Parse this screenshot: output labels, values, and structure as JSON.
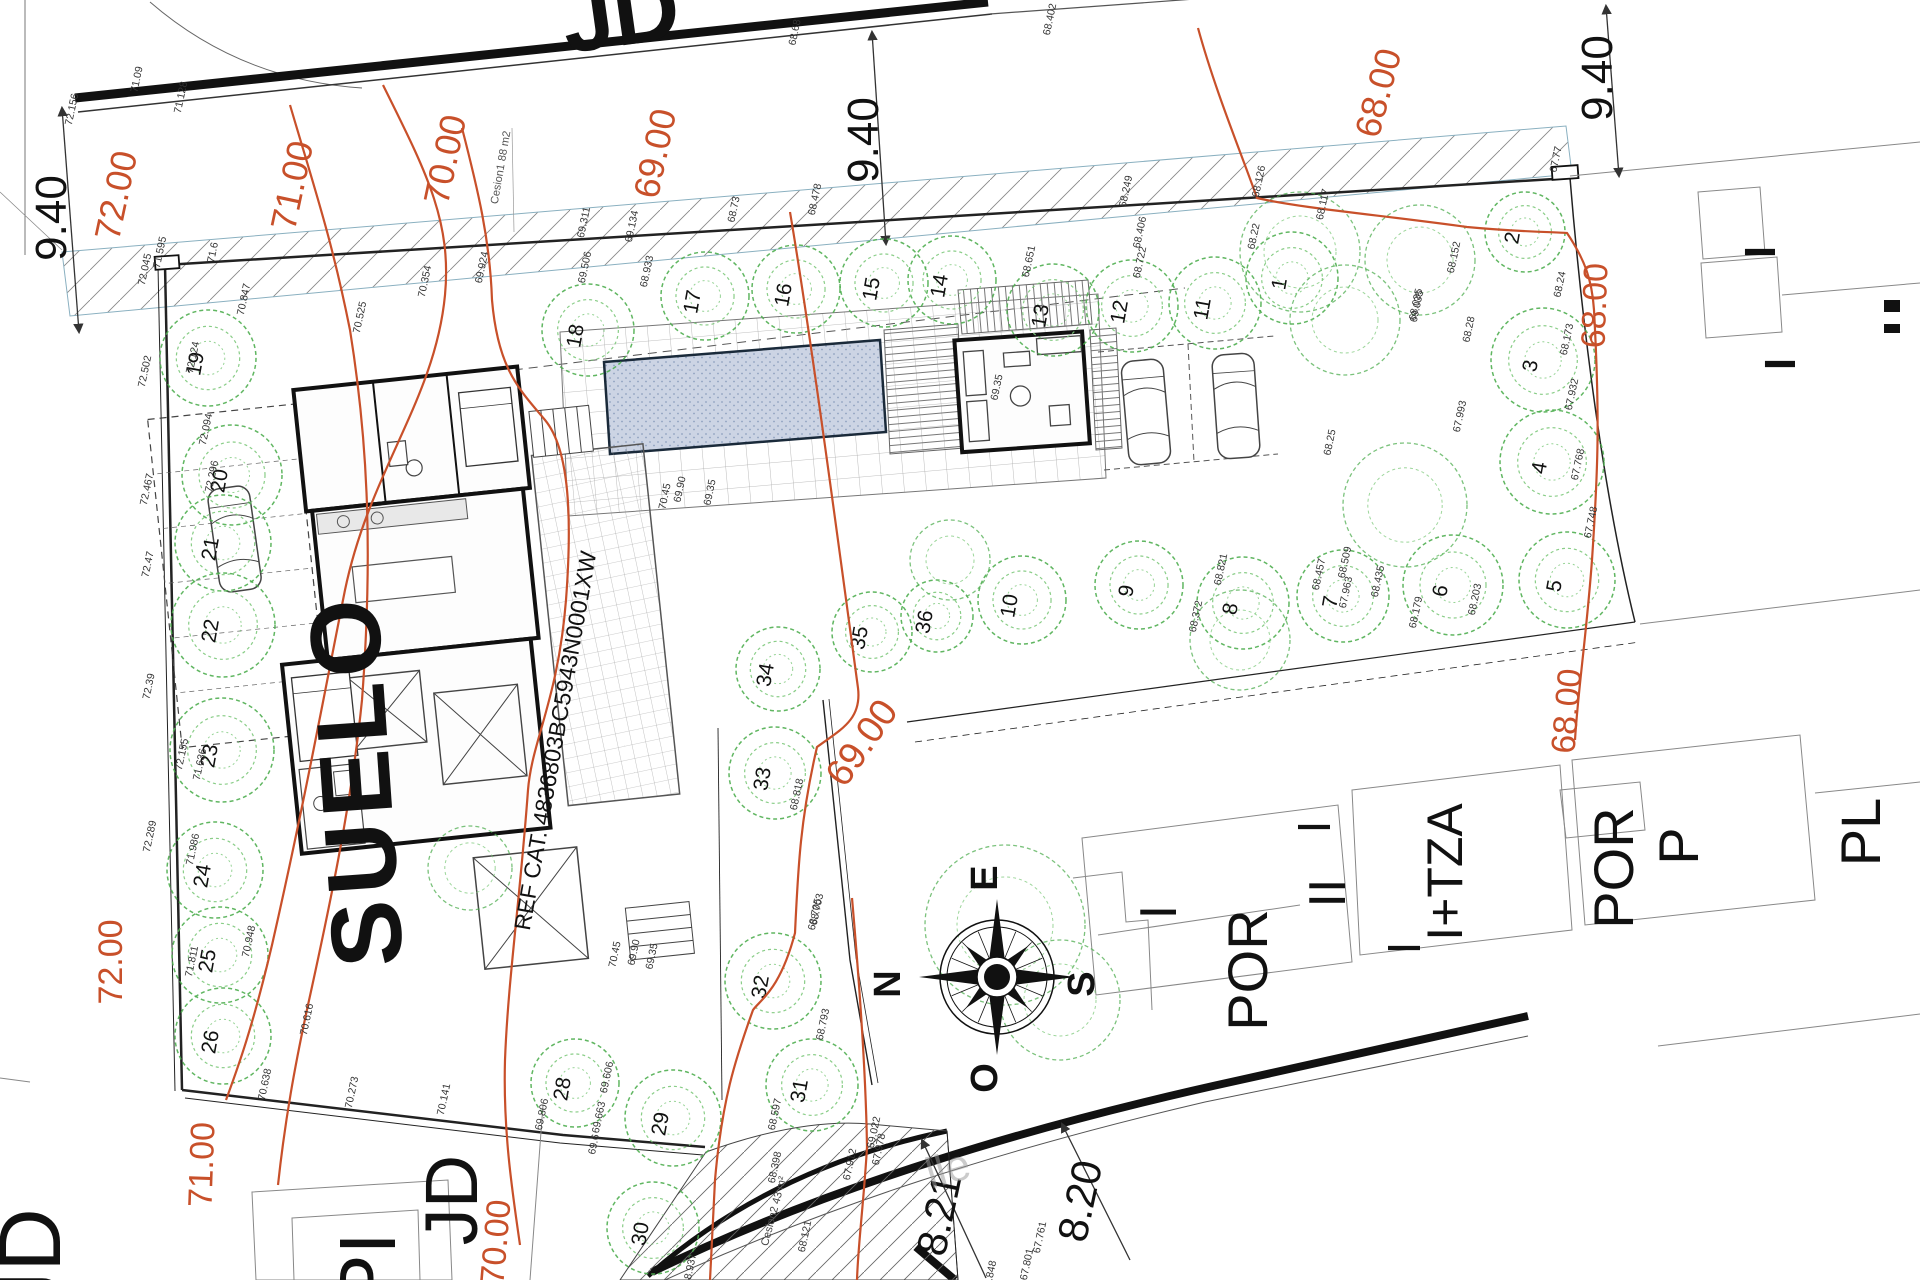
{
  "colors": {
    "contour": "#c8502a",
    "tree": "#4fae50",
    "tree_inner": "#7cc87a",
    "ink": "#111",
    "minor": "#333",
    "pool_fill": "#ccd4e4"
  },
  "contour_lines": [
    {
      "level": "72",
      "d": "M383,85 C425,170 452,220 445,295 C435,400 370,470 345,590 C325,690 305,800 272,945 C252,1030 237,1070 226,1100"
    },
    {
      "level": "71",
      "d": "M290,105 C315,190 332,240 350,330 C366,430 374,540 362,700 C352,800 330,905 308,1005 C295,1065 285,1120 278,1185"
    },
    {
      "level": "70",
      "d": "M462,128 C478,190 490,240 492,300 C498,370 520,390 545,420 C570,450 572,520 566,600 C558,700 532,740 528,790 C520,900 508,980 505,1060 C503,1130 512,1190 520,1245"
    },
    {
      "level": "69",
      "d": "M790,212 C810,330 838,540 858,688 C862,720 840,730 817,747 C800,820 798,870 795,933 C780,990 760,1000 753,1010 C735,1060 722,1100 715,1180 L710,1280"
    },
    {
      "level": "68",
      "d": "M1198,28 C1215,90 1240,150 1257,198 C1300,208 1380,215 1467,227 C1520,232 1555,232 1567,233 C1585,260 1592,280 1594,310 C1600,420 1598,470 1592,560 C1586,640 1578,690 1575,740"
    },
    {
      "level": "68b",
      "d": "M852,898 C860,990 866,1080 867,1147 C864,1200 858,1245 857,1280"
    }
  ],
  "contour_labels": [
    {
      "t": "72.00",
      "x": 128,
      "y": 198,
      "rot": -78,
      "size": 36
    },
    {
      "t": "71.00",
      "x": 304,
      "y": 188,
      "rot": -78,
      "size": 36
    },
    {
      "t": "70.00",
      "x": 457,
      "y": 162,
      "rot": -78,
      "size": 36
    },
    {
      "t": "69.00",
      "x": 667,
      "y": 156,
      "rot": -78,
      "size": 36
    },
    {
      "t": "68.00",
      "x": 1390,
      "y": 96,
      "rot": -75,
      "size": 36
    },
    {
      "t": "68.00",
      "x": 1606,
      "y": 306,
      "rot": -88,
      "size": 34
    },
    {
      "t": "68.00",
      "x": 1578,
      "y": 712,
      "rot": -85,
      "size": 34
    },
    {
      "t": "69.00",
      "x": 872,
      "y": 750,
      "rot": -55,
      "size": 38
    },
    {
      "t": "72.00",
      "x": 122,
      "y": 962,
      "rot": -90,
      "size": 34
    },
    {
      "t": "71.00",
      "x": 213,
      "y": 1165,
      "rot": -88,
      "size": 34
    },
    {
      "t": "70.00",
      "x": 507,
      "y": 1243,
      "rot": -85,
      "size": 34
    }
  ],
  "trees": [
    [
      1,
      1292,
      278,
      46
    ],
    [
      2,
      1525,
      232,
      40
    ],
    [
      3,
      1543,
      360,
      52
    ],
    [
      4,
      1552,
      462,
      52
    ],
    [
      5,
      1567,
      580,
      48
    ],
    [
      6,
      1453,
      585,
      50
    ],
    [
      7,
      1343,
      596,
      46
    ],
    [
      8,
      1243,
      603,
      46
    ],
    [
      9,
      1139,
      585,
      44
    ],
    [
      10,
      1022,
      600,
      44
    ],
    [
      11,
      1215,
      303,
      46
    ],
    [
      12,
      1132,
      306,
      46
    ],
    [
      13,
      1053,
      310,
      46
    ],
    [
      14,
      952,
      280,
      44
    ],
    [
      15,
      884,
      283,
      44
    ],
    [
      16,
      796,
      289,
      44
    ],
    [
      17,
      705,
      296,
      44
    ],
    [
      18,
      588,
      330,
      46
    ],
    [
      19,
      208,
      358,
      48
    ],
    [
      20,
      232,
      475,
      50
    ],
    [
      21,
      223,
      543,
      48
    ],
    [
      22,
      223,
      625,
      52
    ],
    [
      23,
      222,
      750,
      52
    ],
    [
      24,
      215,
      870,
      48
    ],
    [
      25,
      220,
      955,
      48
    ],
    [
      26,
      223,
      1036,
      48
    ],
    [
      28,
      575,
      1083,
      44
    ],
    [
      29,
      673,
      1118,
      48
    ],
    [
      30,
      653,
      1228,
      46
    ],
    [
      31,
      812,
      1085,
      46
    ],
    [
      32,
      773,
      981,
      48
    ],
    [
      33,
      775,
      773,
      46
    ],
    [
      34,
      778,
      669,
      42
    ],
    [
      35,
      872,
      632,
      40
    ],
    [
      36,
      937,
      616,
      36
    ]
  ],
  "green_masses": [
    [
      1300,
      252,
      60
    ],
    [
      1420,
      260,
      55
    ],
    [
      1405,
      505,
      62
    ],
    [
      1345,
      320,
      55
    ],
    [
      1240,
      640,
      50
    ],
    [
      1005,
      925,
      80
    ],
    [
      1060,
      1000,
      60
    ],
    [
      470,
      868,
      42
    ],
    [
      950,
      560,
      40
    ]
  ],
  "spot_elevations": [
    [
      75,
      110,
      "72.156"
    ],
    [
      140,
      80,
      "71.09"
    ],
    [
      184,
      98,
      "71.128"
    ],
    [
      148,
      270,
      "72.045"
    ],
    [
      163,
      253,
      "71.595"
    ],
    [
      216,
      253,
      "71.6"
    ],
    [
      247,
      300,
      "70.847"
    ],
    [
      428,
      282,
      "70.354"
    ],
    [
      485,
      268,
      "69.924"
    ],
    [
      588,
      268,
      "69.506"
    ],
    [
      650,
      272,
      "68.933"
    ],
    [
      587,
      223,
      "69.311"
    ],
    [
      635,
      227,
      "69.134"
    ],
    [
      737,
      210,
      "68.73"
    ],
    [
      818,
      200,
      "68.478"
    ],
    [
      798,
      33,
      "68.68"
    ],
    [
      1053,
      20,
      "68.402"
    ],
    [
      1129,
      192,
      "68.249"
    ],
    [
      1262,
      182,
      "68.126"
    ],
    [
      1326,
      205,
      "68.117"
    ],
    [
      1143,
      233,
      "68.406"
    ],
    [
      1143,
      263,
      "68.722"
    ],
    [
      1032,
      262,
      "68.651"
    ],
    [
      1257,
      237,
      "68.22"
    ],
    [
      1457,
      258,
      "68.152"
    ],
    [
      1419,
      305,
      "68.035"
    ],
    [
      1472,
      330,
      "68.28"
    ],
    [
      1559,
      160,
      "67.77"
    ],
    [
      1563,
      285,
      "68.24"
    ],
    [
      1570,
      340,
      "68.173"
    ],
    [
      1575,
      395,
      "67.932"
    ],
    [
      1420,
      307,
      "69.035"
    ],
    [
      1463,
      417,
      "67.993"
    ],
    [
      1333,
      443,
      "68.25"
    ],
    [
      1581,
      465,
      "67.768"
    ],
    [
      1594,
      523,
      "67.748"
    ],
    [
      1322,
      575,
      "68.457"
    ],
    [
      1348,
      563,
      "68.509"
    ],
    [
      1381,
      582,
      "68.435"
    ],
    [
      1349,
      593,
      "67.963"
    ],
    [
      1419,
      613,
      "68.179"
    ],
    [
      1478,
      600,
      "68.203"
    ],
    [
      1224,
      570,
      "68.821"
    ],
    [
      1199,
      617,
      "68.372"
    ],
    [
      668,
      497,
      "70.45"
    ],
    [
      683,
      490,
      "69.90"
    ],
    [
      713,
      493,
      "69.35"
    ],
    [
      1000,
      388,
      "69.35"
    ],
    [
      363,
      318,
      "70.525"
    ],
    [
      800,
      795,
      "68.818"
    ],
    [
      820,
      910,
      "68.703"
    ],
    [
      618,
      955,
      "70.45"
    ],
    [
      637,
      953,
      "69.90"
    ],
    [
      655,
      957,
      "69.35"
    ],
    [
      826,
      1025,
      "68.793"
    ],
    [
      818,
      915,
      "68.705"
    ],
    [
      778,
      1115,
      "68.597"
    ],
    [
      877,
      1133,
      "69.022"
    ],
    [
      853,
      1165,
      "67.912"
    ],
    [
      882,
      1150,
      "67.978"
    ],
    [
      778,
      1168,
      "68.398"
    ],
    [
      808,
      1237,
      "68.121"
    ],
    [
      693,
      1270,
      "68.937"
    ],
    [
      610,
      1078,
      "69.606"
    ],
    [
      602,
      1118,
      "69.663"
    ],
    [
      597,
      1145,
      "69.6"
    ],
    [
      1043,
      1238,
      "67.761"
    ],
    [
      1030,
      1265,
      "67.801"
    ],
    [
      993,
      1277,
      "67.848"
    ],
    [
      252,
      942,
      "70.948"
    ],
    [
      195,
      962,
      "71.811"
    ],
    [
      268,
      1085,
      "70.638"
    ],
    [
      355,
      1093,
      "70.273"
    ],
    [
      447,
      1100,
      "70.141"
    ],
    [
      310,
      1020,
      "70.616"
    ],
    [
      545,
      1115,
      "69.806"
    ],
    [
      148,
      372,
      "72.502"
    ],
    [
      150,
      490,
      "72.467"
    ],
    [
      151,
      565,
      "72.47"
    ],
    [
      196,
      358,
      "72.124"
    ],
    [
      209,
      430,
      "72.094"
    ],
    [
      215,
      477,
      "72.296"
    ],
    [
      152,
      687,
      "72.39"
    ],
    [
      153,
      837,
      "72.289"
    ],
    [
      185,
      755,
      "72.155"
    ],
    [
      203,
      765,
      "71.636"
    ],
    [
      196,
      850,
      "71.986"
    ]
  ],
  "big_labels": [
    {
      "t": "JD",
      "x": 625,
      "y": 45,
      "rot": -8,
      "size": 92,
      "w": 700
    },
    {
      "t": "SUELO",
      "x": 390,
      "y": 778,
      "rot": -94,
      "size": 100,
      "w": 600,
      "ls": 6
    },
    {
      "t": "REF CAT. 4836803BC5943N0001XW",
      "x": 563,
      "y": 742,
      "rot": -80,
      "size": 23,
      "w": 400
    },
    {
      "t": "POR",
      "x": 1267,
      "y": 970,
      "rot": -90,
      "size": 56
    },
    {
      "t": "I",
      "x": 1176,
      "y": 912,
      "rot": -90,
      "size": 52
    },
    {
      "t": "II",
      "x": 1345,
      "y": 893,
      "rot": -90,
      "size": 52
    },
    {
      "t": "I",
      "x": 1330,
      "y": 827,
      "rot": -90,
      "size": 46
    },
    {
      "t": "I+TZA",
      "x": 1462,
      "y": 872,
      "rot": -90,
      "size": 50
    },
    {
      "t": "I",
      "x": 1420,
      "y": 948,
      "rot": -90,
      "size": 46
    },
    {
      "t": "POR",
      "x": 1633,
      "y": 868,
      "rot": -90,
      "size": 56
    },
    {
      "t": "P",
      "x": 1698,
      "y": 846,
      "rot": -90,
      "size": 56
    },
    {
      "t": "PL",
      "x": 1880,
      "y": 832,
      "rot": -90,
      "size": 56
    },
    {
      "t": "I",
      "x": 1775,
      "y": 252,
      "rot": -90,
      "size": 44,
      "w": 700
    },
    {
      "t": "I",
      "x": 1795,
      "y": 364,
      "rot": -90,
      "size": 44,
      "w": 700
    },
    {
      "t": "JD",
      "x": 60,
      "y": 1262,
      "rot": -90,
      "size": 88
    },
    {
      "t": "PI",
      "x": 395,
      "y": 1270,
      "rot": -90,
      "size": 80
    },
    {
      "t": "JD",
      "x": 477,
      "y": 1200,
      "rot": -90,
      "size": 74
    },
    {
      "t": "9.40",
      "x": 66,
      "y": 218,
      "rot": -90,
      "size": 44
    },
    {
      "t": "9.40",
      "x": 878,
      "y": 140,
      "rot": -90,
      "size": 44
    },
    {
      "t": "9.40",
      "x": 1612,
      "y": 78,
      "rot": -90,
      "size": 44
    },
    {
      "t": "8.21",
      "x": 953,
      "y": 1218,
      "rot": -78,
      "size": 42
    },
    {
      "t": "8.20",
      "x": 1094,
      "y": 1204,
      "rot": -78,
      "size": 42
    },
    {
      "t": "Cesion1 88 m2",
      "x": 504,
      "y": 168,
      "rot": -80,
      "size": 11,
      "c": "#555"
    },
    {
      "t": "Cesion2 43 m²",
      "x": 777,
      "y": 1212,
      "rot": -75,
      "size": 11,
      "c": "#444"
    },
    {
      "t": "lle",
      "x": 952,
      "y": 1183,
      "rot": -16,
      "size": 44,
      "c": "#999",
      "o": 0.5
    },
    {
      "t": "71.00",
      "x": 393,
      "y": 118,
      "rot": -78,
      "size": 0,
      "c": "#c8502a"
    }
  ],
  "compass": {
    "cx": 997,
    "cy": 977,
    "r": 57,
    "labels": [
      [
        "E",
        997,
        878
      ],
      [
        "N",
        900,
        984
      ],
      [
        "S",
        1094,
        984
      ],
      [
        "O",
        997,
        1078
      ]
    ]
  }
}
